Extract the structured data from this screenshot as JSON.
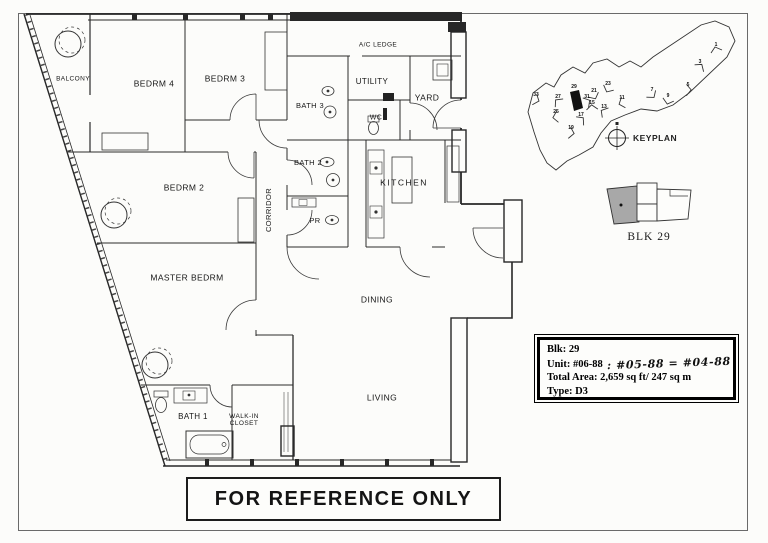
{
  "scan": {
    "reference_notice": "FOR REFERENCE ONLY"
  },
  "info_box": {
    "blk_label": "Blk: 29",
    "unit_label": "Unit: #06-88",
    "unit_handwritten_note": ": #05-88 = #04-88",
    "total_area_label": "Total Area: 2,659 sq ft/ 247 sq m",
    "type_label": "Type: D3"
  },
  "keyplan": {
    "title": "KEYPLAN",
    "highlighted_block": "29",
    "blocks": [
      {
        "num": "1",
        "x": 716,
        "y": 46
      },
      {
        "num": "3",
        "x": 700,
        "y": 63
      },
      {
        "num": "5",
        "x": 688,
        "y": 86
      },
      {
        "num": "7",
        "x": 652,
        "y": 91
      },
      {
        "num": "9",
        "x": 668,
        "y": 97
      },
      {
        "num": "11",
        "x": 622,
        "y": 99
      },
      {
        "num": "13",
        "x": 604,
        "y": 108
      },
      {
        "num": "15",
        "x": 592,
        "y": 104
      },
      {
        "num": "17",
        "x": 581,
        "y": 116
      },
      {
        "num": "19",
        "x": 571,
        "y": 129
      },
      {
        "num": "21",
        "x": 594,
        "y": 92
      },
      {
        "num": "23",
        "x": 608,
        "y": 85
      },
      {
        "num": "25",
        "x": 556,
        "y": 113
      },
      {
        "num": "27",
        "x": 558,
        "y": 98
      },
      {
        "num": "29",
        "x": 574,
        "y": 88
      },
      {
        "num": "31",
        "x": 587,
        "y": 98
      },
      {
        "num": "33",
        "x": 536,
        "y": 96
      }
    ]
  },
  "block_diagram": {
    "label": "BLK 29"
  },
  "floorplan": {
    "rooms": [
      {
        "id": "balcony",
        "label": "BALCONY",
        "x": 73,
        "y": 80,
        "fs": 6.5
      },
      {
        "id": "bedrm4",
        "label": "BEDRM 4",
        "x": 154,
        "y": 84,
        "fs": 8.5
      },
      {
        "id": "bedrm3",
        "label": "BEDRM 3",
        "x": 225,
        "y": 79,
        "fs": 8.5
      },
      {
        "id": "ac-ledge",
        "label": "A/C LEDGE",
        "x": 378,
        "y": 46,
        "fs": 6.5
      },
      {
        "id": "utility",
        "label": "UTILITY",
        "x": 372,
        "y": 82,
        "fs": 8
      },
      {
        "id": "yard",
        "label": "YARD",
        "x": 427,
        "y": 98,
        "fs": 8.5
      },
      {
        "id": "bath3",
        "label": "BATH 3",
        "x": 310,
        "y": 106,
        "fs": 7.5
      },
      {
        "id": "wc",
        "label": "WC",
        "x": 376,
        "y": 118,
        "fs": 7
      },
      {
        "id": "bath2",
        "label": "BATH 2",
        "x": 308,
        "y": 163,
        "fs": 7.5
      },
      {
        "id": "kitchen",
        "label": "KITCHEN",
        "x": 404,
        "y": 183,
        "fs": 8.5,
        "ls": 1.5
      },
      {
        "id": "corridor",
        "label": "CORRIDOR",
        "x": 269,
        "y": 210,
        "fs": 7.5,
        "rot": -90
      },
      {
        "id": "pr",
        "label": "PR",
        "x": 315,
        "y": 221,
        "fs": 7.5
      },
      {
        "id": "bedrm2",
        "label": "BEDRM 2",
        "x": 184,
        "y": 188,
        "fs": 8.5
      },
      {
        "id": "master-bedrm",
        "label": "MASTER BEDRM",
        "x": 187,
        "y": 278,
        "fs": 8.5
      },
      {
        "id": "dining",
        "label": "DINING",
        "x": 377,
        "y": 300,
        "fs": 8.5
      },
      {
        "id": "living",
        "label": "LIVING",
        "x": 382,
        "y": 398,
        "fs": 8.5
      },
      {
        "id": "bath1",
        "label": "BATH 1",
        "x": 193,
        "y": 417,
        "fs": 8
      },
      {
        "id": "walkin-closet",
        "label": "WALK-IN CLOSET",
        "x": 244,
        "y": 421,
        "fs": 6.5,
        "w": 44
      }
    ]
  }
}
